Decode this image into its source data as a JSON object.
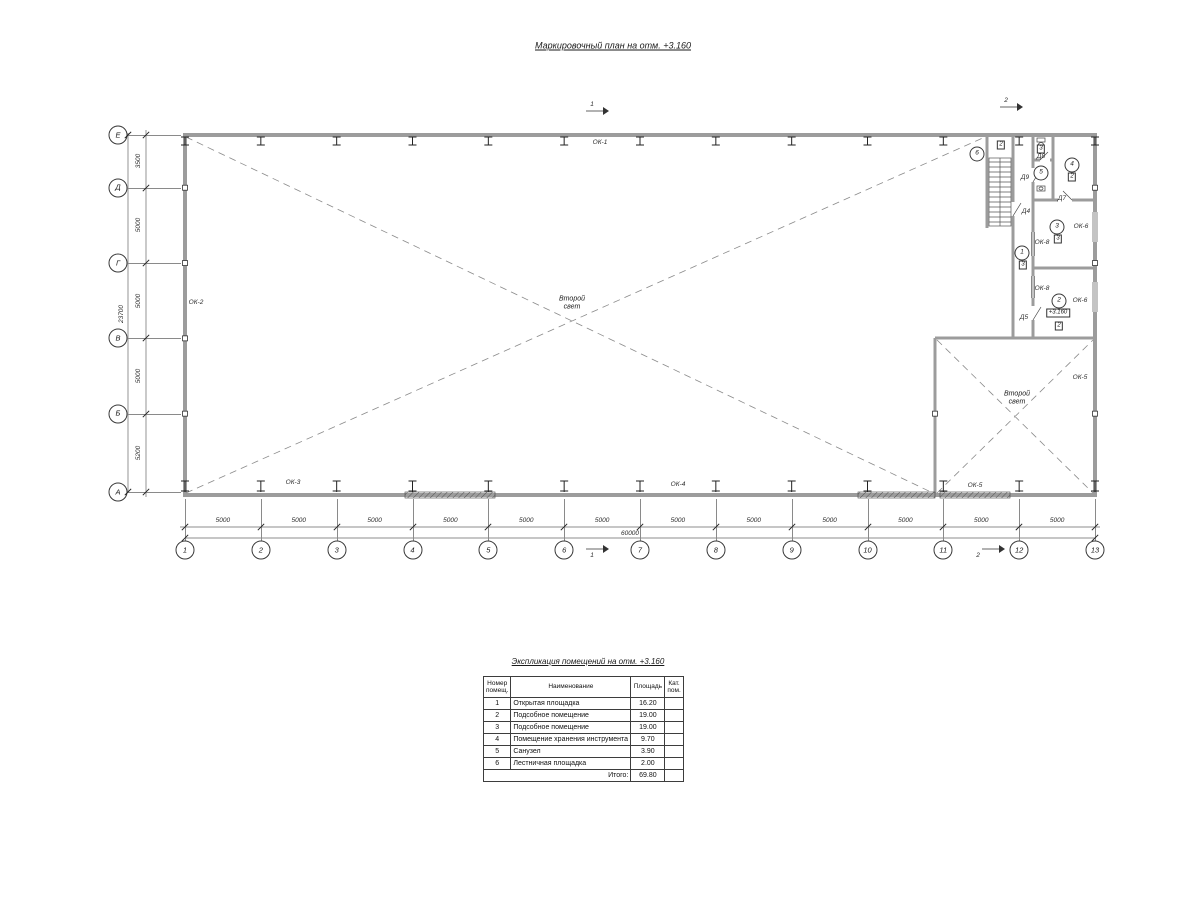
{
  "drawing_title": "Маркировочный план на отм. +3.160",
  "plan": {
    "axes_left": [
      "Е",
      "Д",
      "Г",
      "В",
      "Б",
      "А"
    ],
    "v_dims": [
      "3500",
      "5000",
      "5000",
      "5000",
      "5200"
    ],
    "v_total": "23700",
    "columns": [
      "1",
      "2",
      "3",
      "4",
      "5",
      "6",
      "7",
      "8",
      "9",
      "10",
      "11",
      "12",
      "13"
    ],
    "h_dims": [
      "5000",
      "5000",
      "5000",
      "5000",
      "5000",
      "5000",
      "5000",
      "5000",
      "5000",
      "5000",
      "5000",
      "5000"
    ],
    "h_total": "60000",
    "section_marks": {
      "s1": "1",
      "s2": "2"
    },
    "second_light": {
      "line1": "Второй",
      "line2": "свет"
    },
    "level_mark": "+3.160",
    "window_tags": {
      "ok1": "ОК-1",
      "ok2": "ОК-2",
      "ok3": "ОК-3",
      "ok4": "ОК-4",
      "ok5_right": "ОК-5",
      "ok5_bottom": "ОК-5",
      "ok6_room3": "ОК-6",
      "ok6_room2": "ОК-6",
      "ok8_room3": "ОК-8",
      "ok8_room2": "ОК-8"
    },
    "door_tags": {
      "d4": "Д4",
      "d5": "Д5",
      "d7": "Д7",
      "d8": "Д8",
      "d9": "Д9"
    },
    "rooms": {
      "r1": {
        "num": "1",
        "cat": "3"
      },
      "r2": {
        "num": "2",
        "cat": "2"
      },
      "r3": {
        "num": "3",
        "cat": "3"
      },
      "r4": {
        "num": "4",
        "cat": "2"
      },
      "r5": {
        "num": "5",
        "cat": "3"
      },
      "r6": {
        "num": "6",
        "cat": "2"
      }
    }
  },
  "explication": {
    "title": "Экспликация помещений на отм. +3.160",
    "headers": {
      "num": "Номер помещ.",
      "name": "Наименование",
      "area": "Площадь",
      "cat": "Кат. пом."
    },
    "rows": [
      {
        "num": "1",
        "name": "Открытая площадка",
        "area": "16.20",
        "cat": ""
      },
      {
        "num": "2",
        "name": "Подсобное помещение",
        "area": "19.00",
        "cat": ""
      },
      {
        "num": "3",
        "name": "Подсобное помещение",
        "area": "19.00",
        "cat": ""
      },
      {
        "num": "4",
        "name": "Помещение хранения инструмента",
        "area": "9.70",
        "cat": ""
      },
      {
        "num": "5",
        "name": "Санузел",
        "area": "3.90",
        "cat": ""
      },
      {
        "num": "6",
        "name": "Лестничная площадка",
        "area": "2.00",
        "cat": ""
      }
    ],
    "total_label": "Итого:",
    "total_value": "69.80"
  }
}
